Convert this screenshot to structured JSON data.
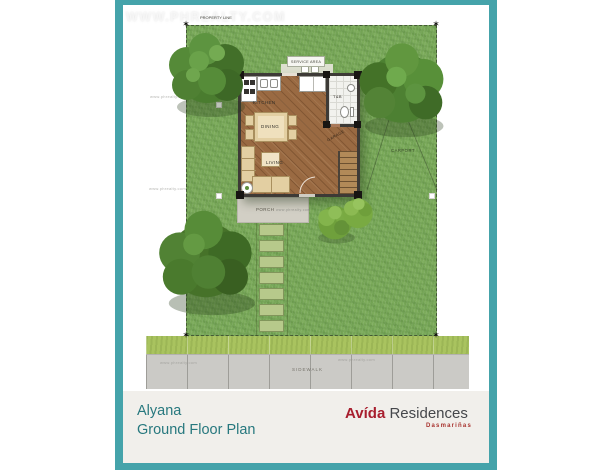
{
  "watermarks": {
    "large": "WWW.PHREALTY.COM",
    "small": "www.phrealty.com"
  },
  "plan": {
    "property_line": "PROPERTY LINE",
    "service_area": "SERVICE AREA",
    "carport": "CARPORT",
    "porch": "PORCH",
    "sidewalk": "SIDEWALK",
    "garage": "GARAGE",
    "rooms": {
      "kitchen": "KITCHEN",
      "dining": "DINING",
      "living": "LIVING",
      "toilet_bath": "T&B"
    }
  },
  "footer": {
    "project_name": "Alyana",
    "plan_title": "Ground Floor Plan",
    "brand_primary": "Avída",
    "brand_secondary": "Residences",
    "brand_location": "Dasmariñas"
  },
  "colors": {
    "frame_teal": "#45a3aa",
    "footer_text_teal": "#27787e",
    "brand_red": "#a81e2e",
    "lawn_green": "#7cab5b",
    "wood_floor": "#9a6a42"
  }
}
